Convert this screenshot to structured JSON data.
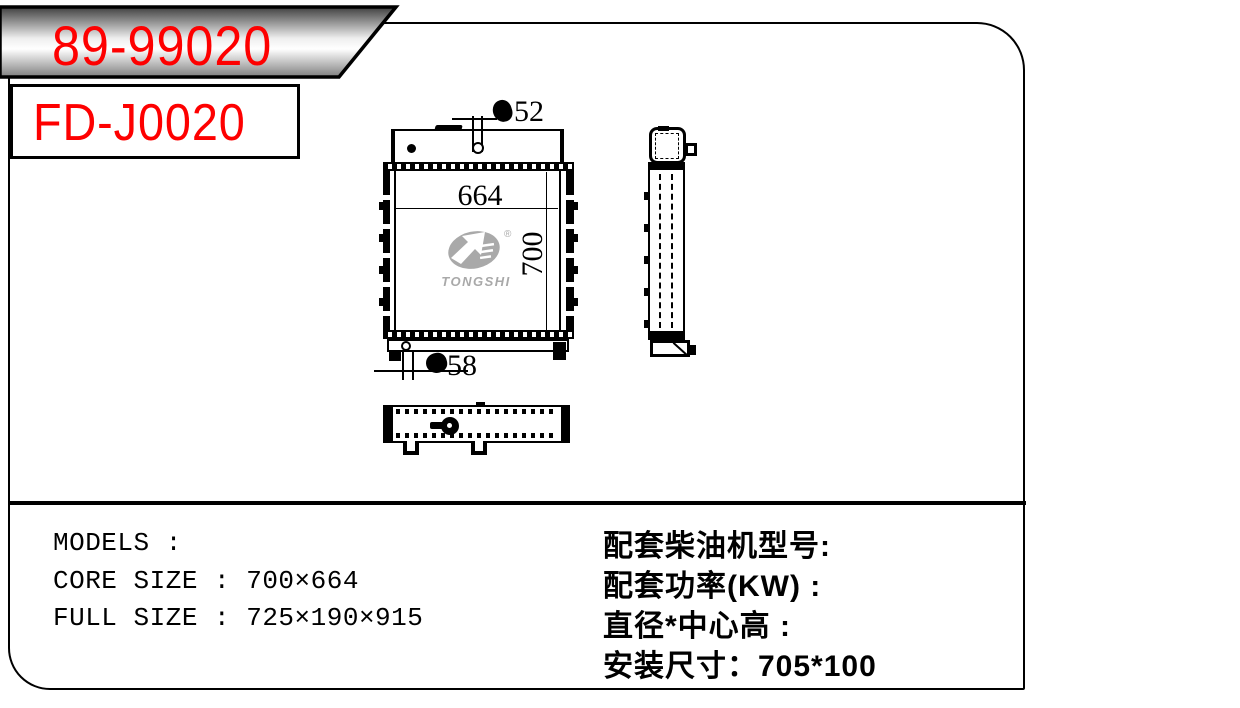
{
  "header": {
    "part_number": "89-99020",
    "model_code": "FD-J0020"
  },
  "drawing": {
    "front_view": {
      "top_port_diameter_label": "52",
      "bottom_port_diameter_label": "58",
      "core_width_label": "664",
      "core_height_label": "700"
    },
    "logo": {
      "brand": "TONGSHI",
      "registered_mark": "®"
    }
  },
  "specs": {
    "left": [
      "MODELS :",
      "CORE SIZE : 700×664",
      "FULL SIZE : 725×190×915"
    ],
    "right": [
      "配套柴油机型号:",
      "配套功率(KW) :",
      "直径*中心高 :",
      "安装尺寸：705*100"
    ]
  },
  "colors": {
    "accent_red": "#fe0000",
    "logo_gray": "#a9a9a9",
    "line_black": "#000000",
    "banner_gradient_top": "#3f3f3f",
    "banner_gradient_mid": "#ffffff",
    "banner_gradient_bottom": "#7f7f7f"
  }
}
